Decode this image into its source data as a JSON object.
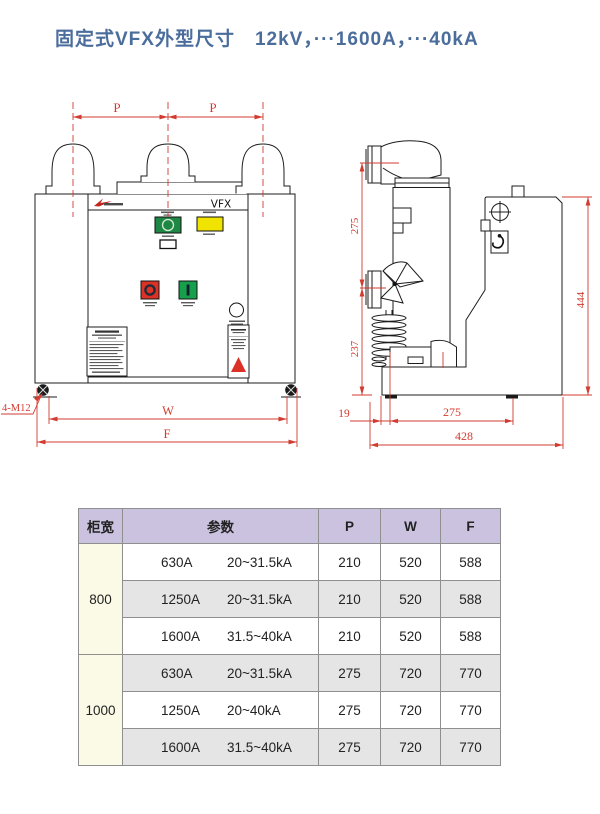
{
  "page": {
    "title": "固定式VFX外型尺寸　12kV，···1600A，···40kA"
  },
  "front_view": {
    "model_label": "VFX",
    "dims": {
      "pitch_left": "P",
      "pitch_right": "P",
      "width": "W",
      "frame": "F",
      "mounting_holes": "4-M12"
    }
  },
  "side_view": {
    "dims": {
      "upper_pole_height": "275",
      "lower_height": "237",
      "total_height": "444",
      "front_offset": "19",
      "depth_pitch": "275",
      "total_depth": "428"
    }
  },
  "table": {
    "headers": {
      "cabinet_width": "柜宽",
      "parameters": "参数",
      "p": "P",
      "w": "W",
      "f": "F"
    },
    "groups": [
      {
        "cabinet_width": "800",
        "rows": [
          {
            "current": "630A",
            "breaking": "20~31.5kA",
            "p": "210",
            "w": "520",
            "f": "588"
          },
          {
            "current": "1250A",
            "breaking": "20~31.5kA",
            "p": "210",
            "w": "520",
            "f": "588"
          },
          {
            "current": "1600A",
            "breaking": "31.5~40kA",
            "p": "210",
            "w": "520",
            "f": "588"
          }
        ]
      },
      {
        "cabinet_width": "1000",
        "rows": [
          {
            "current": "630A",
            "breaking": "20~31.5kA",
            "p": "275",
            "w": "720",
            "f": "770"
          },
          {
            "current": "1250A",
            "breaking": "20~40kA",
            "p": "275",
            "w": "720",
            "f": "770"
          },
          {
            "current": "1600A",
            "breaking": "31.5~40kA",
            "p": "275",
            "w": "720",
            "f": "770"
          }
        ]
      }
    ]
  },
  "colors": {
    "title_blue": "#4a6d9c",
    "dimension_red": "#d23b2f",
    "table_header_purple": "#cbc2df",
    "width_column_cream": "#fbfae6",
    "row_alt_gray": "#e5e5e5",
    "indicator_green": "#1e8744",
    "indicator_yellow": "#f0e300",
    "button_red": "#dc3127",
    "button_green": "#17a04c"
  }
}
